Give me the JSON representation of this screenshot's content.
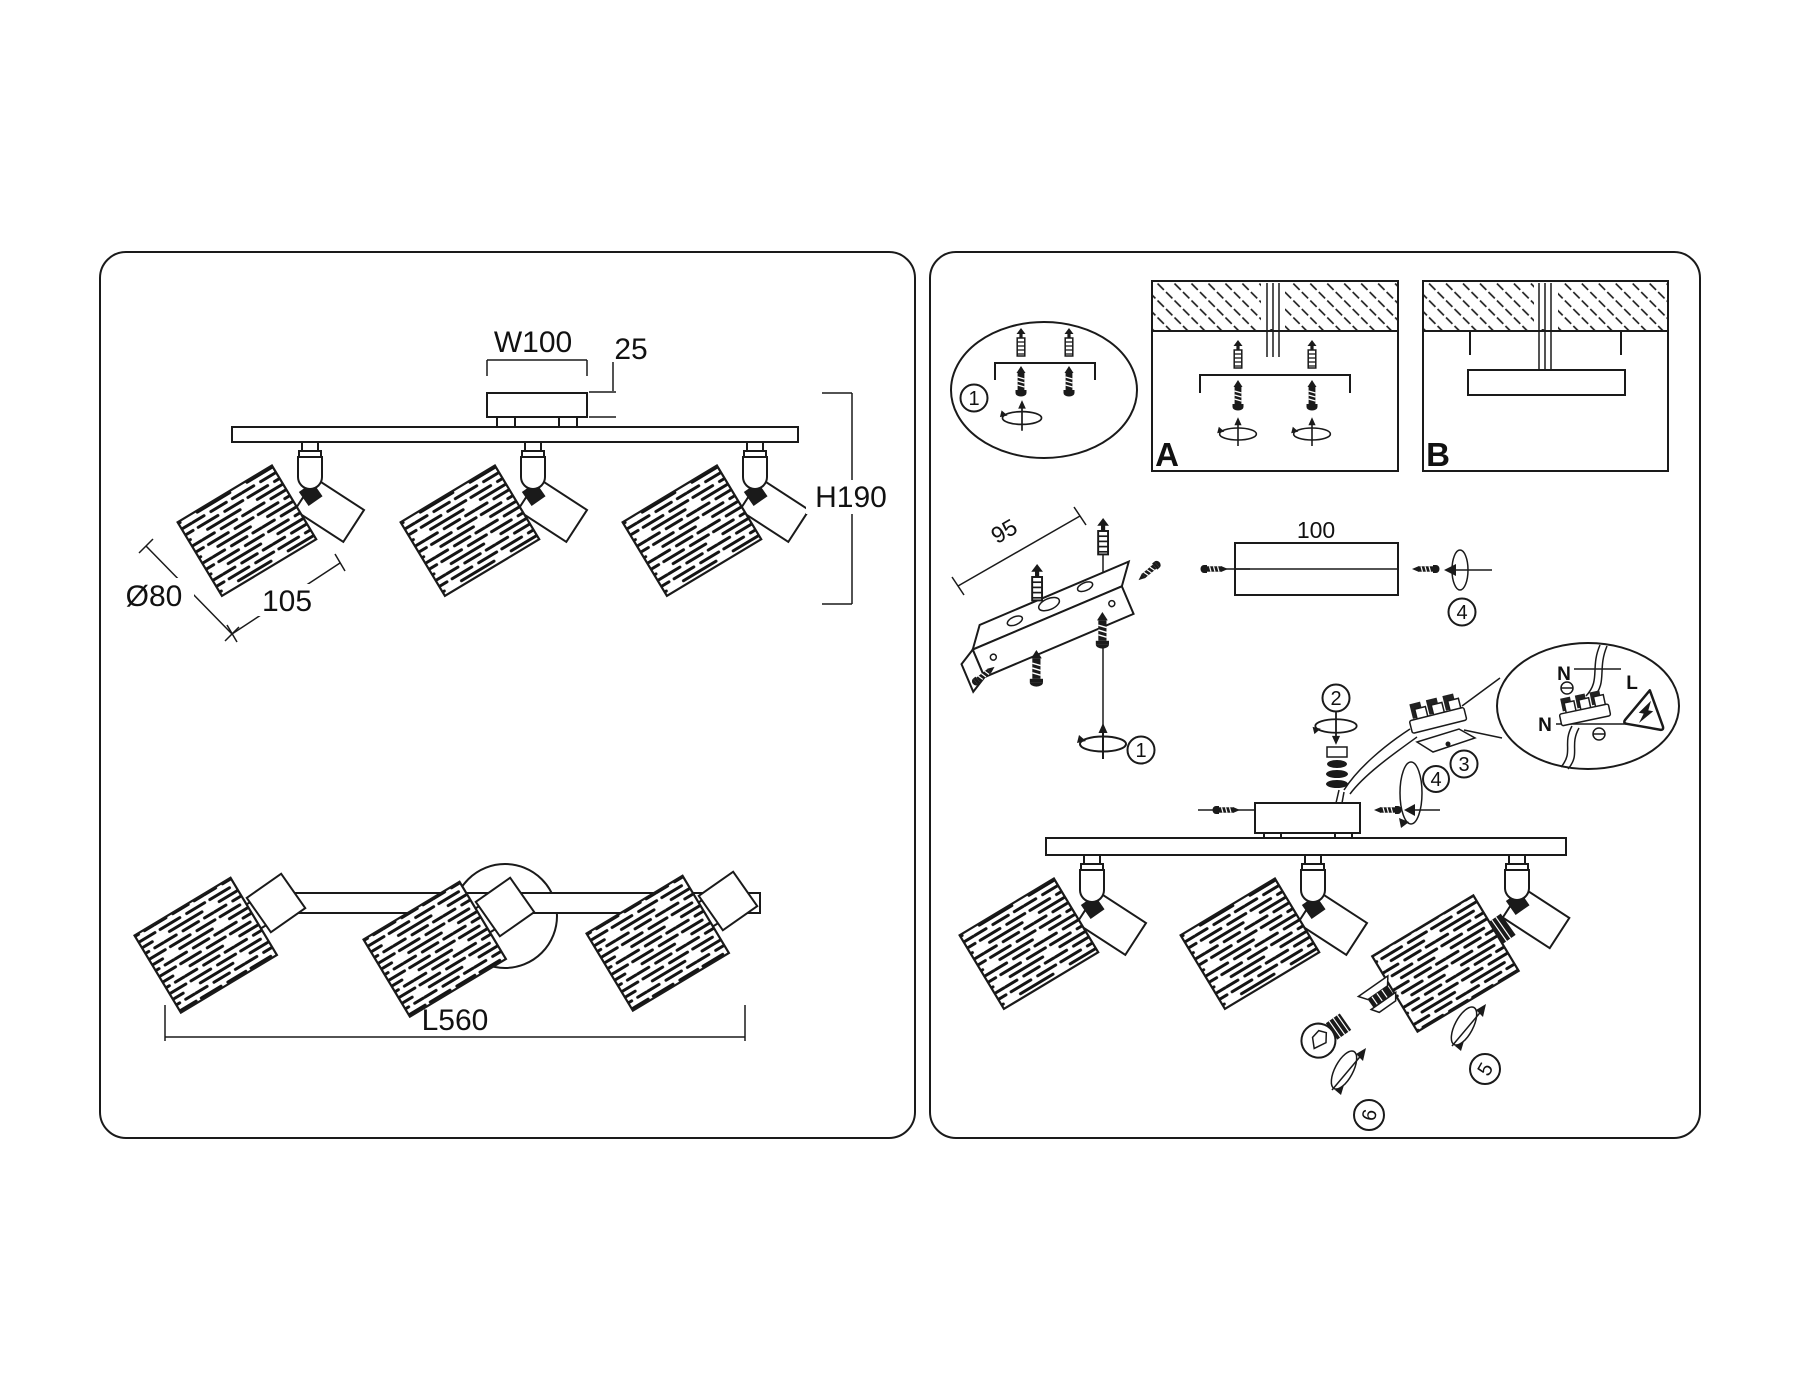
{
  "title": "Ceiling spot luminaire installation and dimensions diagram",
  "colors": {
    "line": "#1a1a1a",
    "background": "#ffffff"
  },
  "icons": [
    "wall-plug-icon",
    "screw-icon",
    "rotate-arrow-icon",
    "warning-triangle-icon",
    "bulb-icon",
    "terminal-block-icon",
    "lamp-shade-icon"
  ],
  "left_panel": {
    "front_view": {
      "width_label": "W100",
      "plate_thickness_label": "25",
      "height_label": "H190",
      "shade_diameter_label": "Ø80",
      "shade_length_label": "105"
    },
    "top_view": {
      "length_label": "L560"
    }
  },
  "right_panel": {
    "mount_variant_a_label": "A",
    "mount_variant_b_label": "B",
    "bracket_length_label": "95",
    "bar_length_label": "100",
    "steps": {
      "s1": "1",
      "s2": "2",
      "s3": "3",
      "s4": "4",
      "s5": "5",
      "s6": "6"
    },
    "wiring_detail": {
      "neutral_label": "N",
      "live_label": "L",
      "neutral2_label": "N"
    }
  }
}
